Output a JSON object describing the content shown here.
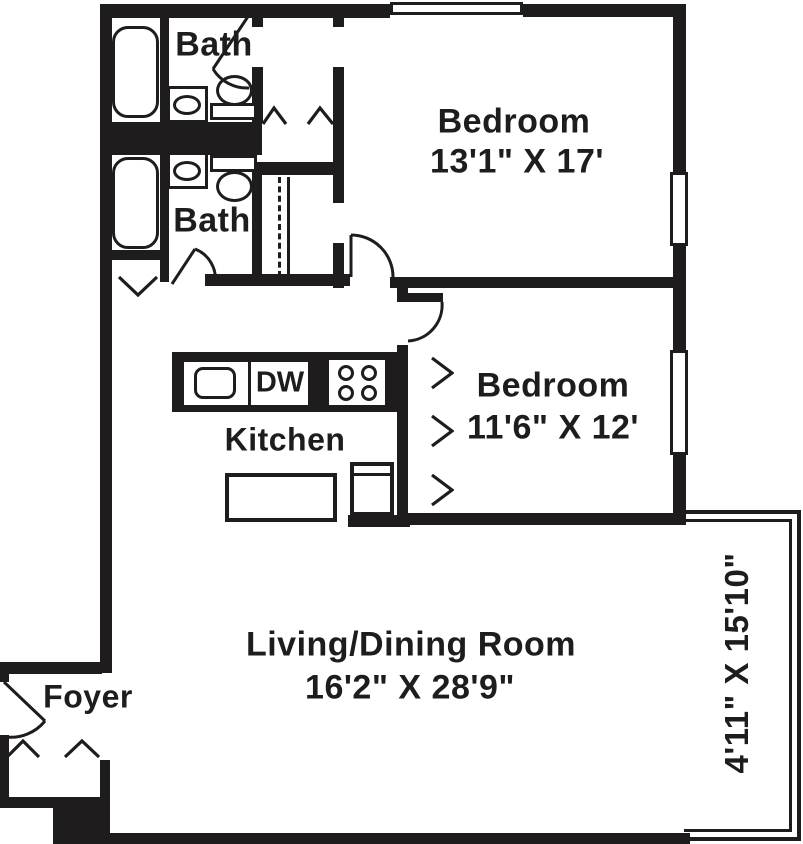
{
  "floor_plan": {
    "colors": {
      "wall": "#1e1c1d",
      "background": "#ffffff"
    },
    "bath_top": {
      "label": "Bath"
    },
    "bath_bottom": {
      "label": "Bath"
    },
    "bedroom_top": {
      "label": "Bedroom",
      "dimensions": "13'1\" X 17'"
    },
    "bedroom_middle": {
      "label": "Bedroom",
      "dimensions": "11'6\" X 12'"
    },
    "kitchen": {
      "label": "Kitchen",
      "dishwasher_label": "DW"
    },
    "living_dining": {
      "label": "Living/Dining Room",
      "dimensions": "16'2\" X 28'9\""
    },
    "foyer": {
      "label": "Foyer"
    },
    "balcony": {
      "dimensions": "4'11\" X 15'10\""
    }
  }
}
